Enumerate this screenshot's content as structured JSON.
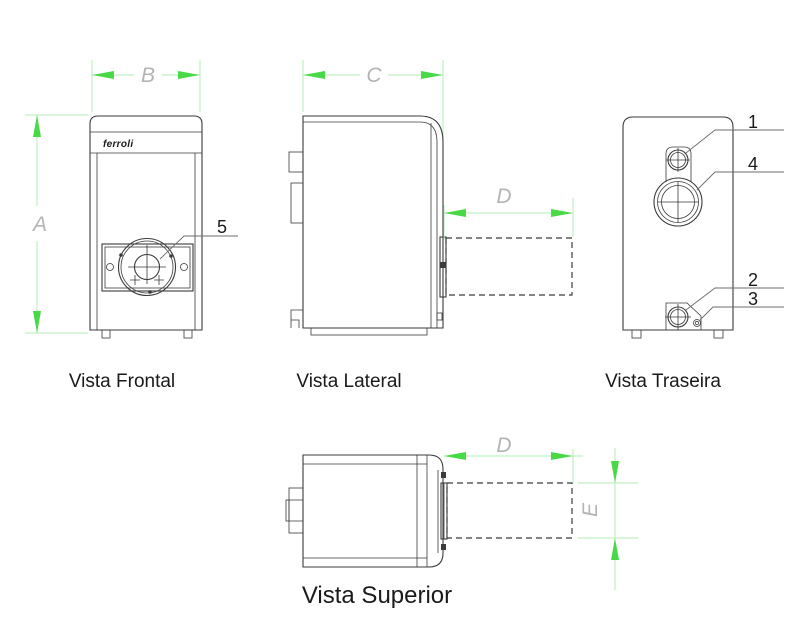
{
  "drawing": {
    "brand_label": "ferroli",
    "views": {
      "frontal": {
        "title": "Vista Frontal"
      },
      "lateral": {
        "title": "Vista Lateral"
      },
      "traseira": {
        "title": "Vista Traseira"
      },
      "superior": {
        "title": "Vista Superior"
      }
    },
    "dimension_labels": {
      "a": "A",
      "b": "B",
      "c": "C",
      "d_side": "D",
      "d_top": "D",
      "e": "E"
    },
    "callout_labels": {
      "n1": "1",
      "n2": "2",
      "n3": "3",
      "n4": "4",
      "n5": "5"
    },
    "colors": {
      "arrow_green": "#48d848",
      "dim_line_green": "#b4edb4",
      "dim_text_gray": "#b4b4b4",
      "drawing_line": "#3b3b3b",
      "leader_line": "#6e6e6e",
      "text_dark": "#1a1a1a",
      "background": "#ffffff"
    }
  }
}
